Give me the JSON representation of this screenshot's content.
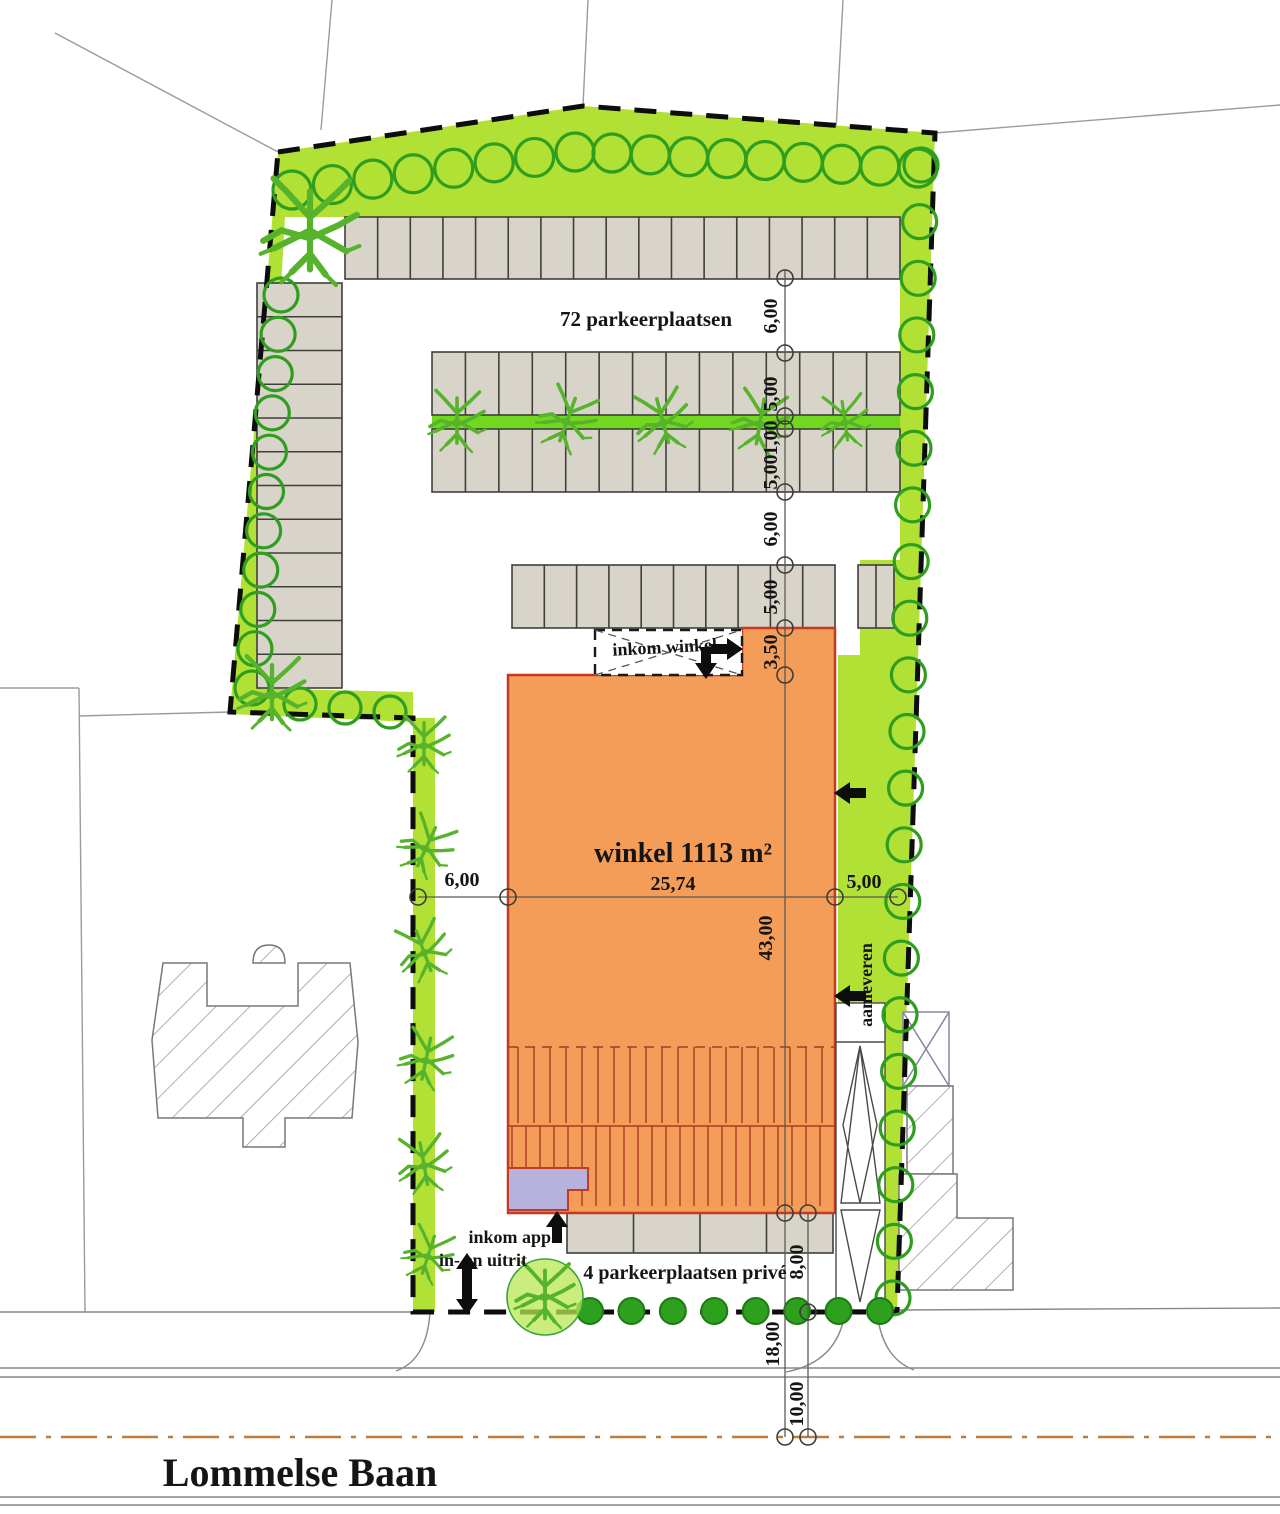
{
  "plan": {
    "road_name": "Lommelse Baan",
    "labels": {
      "parking_total": "72 parkeerplaatsen",
      "shop_entrance": "inkom winkel",
      "shop_area": "winkel 1113 m²",
      "delivery": "aanleveren",
      "apartment_entrance": "inkom app.",
      "driveway": "in- en uitrit",
      "private_parking": "4 parkeerplaatsen privé"
    },
    "dimensions": {
      "top_aisle": "6,00",
      "upper_stall_depth": "5,00",
      "tree_strip": "1,00",
      "lower_stall_depth": "5,00",
      "south_aisle": "6,00",
      "south_stall_depth": "5,00",
      "entrance_depth": "3,50",
      "building_length": "43,00",
      "building_width": "25,74",
      "west_gap": "6,00",
      "east_gap": "5,00",
      "building_to_boundary": "8,00",
      "building_to_road_axis": "18,00",
      "boundary_to_road_axis": "10,00"
    },
    "colors": {
      "green_strip": "#b2e135",
      "tree_strip": "#72d81f",
      "building": "#f49d58",
      "building_outline": "#c23b22",
      "stall_fill": "#d8d4c9",
      "apartment_entry": "#b7b1de",
      "road_axis_line": "#bf7a3e",
      "road_label": "#c23418",
      "shop_label": "#d42a10",
      "tree_stroke": "#2f9e1f"
    }
  }
}
